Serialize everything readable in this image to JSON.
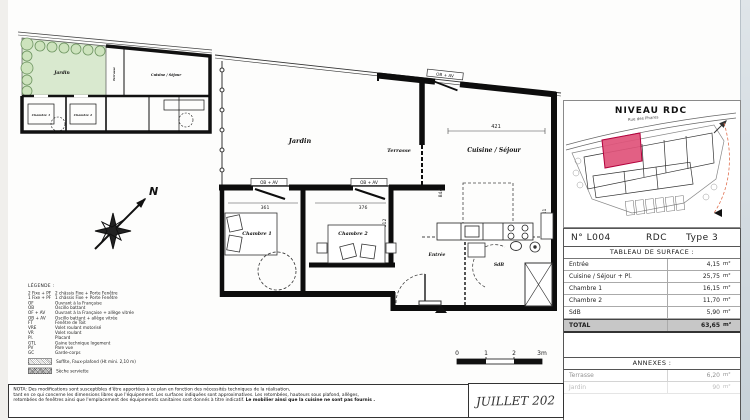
{
  "plan": {
    "rooms": {
      "jardin": "Jardin",
      "terrasse": "Terrasse",
      "cuisine": "Cuisine / Séjour",
      "chambre1": "Chambre 1",
      "chambre2": "Chambre 2",
      "entree": "Entrée",
      "sdb": "SdB"
    },
    "window_label": "OB + AV",
    "dims": {
      "top_width": "421",
      "right_height": "341",
      "left_height": "844",
      "chambre1_width": "361",
      "chambre2_width": "376",
      "chambre1_height": "415",
      "chambre2_height": "312"
    },
    "compass_label": "N"
  },
  "site_map": {
    "title": "NIVEAU RDC",
    "street": "Rue des Phares",
    "highlight_color": "#e0537a"
  },
  "surface_table": {
    "lot": "N° L004",
    "level": "RDC",
    "type": "Type 3",
    "header": "TABLEAU DE SURFACE :",
    "rows": [
      {
        "label": "Entrée",
        "value": "4,15",
        "unit": "m²"
      },
      {
        "label": "Cuisine / Séjour + Pl.",
        "value": "25,75",
        "unit": "m²"
      },
      {
        "label": "Chambre 1",
        "value": "16,15",
        "unit": "m²"
      },
      {
        "label": "Chambre 2",
        "value": "11,70",
        "unit": "m²"
      },
      {
        "label": "SdB",
        "value": "5,90",
        "unit": "m²"
      }
    ],
    "total": {
      "label": "TOTAL",
      "value": "63,65",
      "unit": "m²"
    }
  },
  "annexes": {
    "title": "ANNEXES :",
    "rows": [
      {
        "label": "Terrasse",
        "value": "6,20",
        "unit": "m²"
      },
      {
        "label": "Jardin",
        "value": "90",
        "unit": "m²"
      }
    ]
  },
  "legend": {
    "title": "LÉGENDE :",
    "items": [
      {
        "abbr": "2 Fixe + PF",
        "desc": "2 châssis Fixe + Porte Fenêtre"
      },
      {
        "abbr": "1 Fixe + PF",
        "desc": "1 châssis Fixe + Porte Fenêtre"
      },
      {
        "abbr": "OF",
        "desc": "Ouvrant à la Française"
      },
      {
        "abbr": "OB",
        "desc": "Oscillo battant"
      },
      {
        "abbr": "OF + AV",
        "desc": "Ouvrant à la Française + allège vitrée"
      },
      {
        "abbr": "OB + AV",
        "desc": "Oscillo battant + allège vitrée"
      },
      {
        "abbr": "FT",
        "desc": "Fenêtre de Toit"
      },
      {
        "abbr": "VRE",
        "desc": "Volet roulant motorisé"
      },
      {
        "abbr": "VR",
        "desc": "Volet roulant"
      },
      {
        "abbr": "Pl.",
        "desc": "Placard"
      },
      {
        "abbr": "GTL",
        "desc": "Gaine technique logement"
      },
      {
        "abbr": "PV",
        "desc": "Pare vue"
      },
      {
        "abbr": "GC",
        "desc": "Garde-corps"
      }
    ],
    "swatches": [
      {
        "desc": "Soffite, Faux-plafond (Ht mini. 2,10 m)"
      },
      {
        "desc": "Sèche serviette"
      }
    ]
  },
  "nota": {
    "line1": "NOTA: Des modifications sont susceptibles d'être apportées à ce plan en fonction des nécessités techniques de la réalisation,",
    "line2": "tant en ce qui concerne les dimensions libres que l'équipement. Les surfaces indiquées sont approximatives. Les retombées, hauteurs sous plafond, allèges,",
    "line3": "retombées de fenêtres ainsi que l'emplacement des équipements sanitaires sont donnés à titre indicatif. ",
    "line3_bold": "Le mobilier ainsi que la cuisine ne sont pas fournis ."
  },
  "title_block": {
    "date": "JUILLET 202"
  },
  "scale_bar": {
    "t0": "0",
    "t1": "1",
    "t2": "2",
    "t3": "3m"
  }
}
